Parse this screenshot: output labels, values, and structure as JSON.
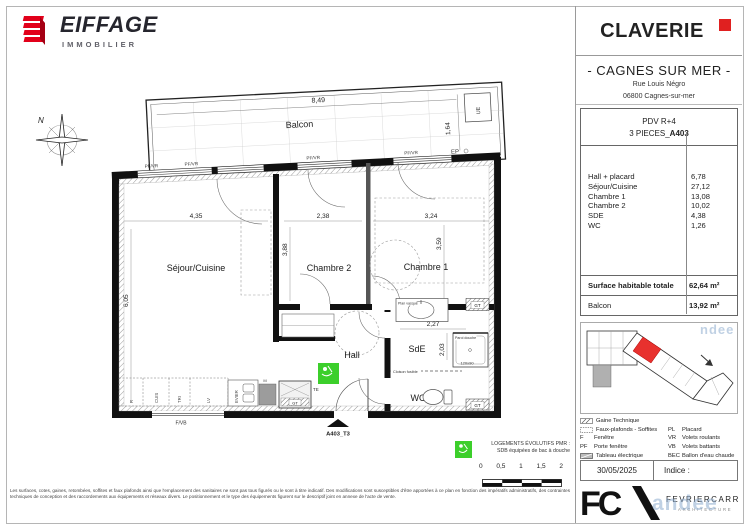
{
  "colors": {
    "accent_red": "#e2001a",
    "pmr_green": "#3ccf2b",
    "keyplan_red": "#e8312e",
    "watermark_blue": "#9db8d2"
  },
  "header": {
    "brand": "EIFFAGE",
    "brand_sub": "IMMOBILIER",
    "project": "CLAVERIE",
    "city": "- CAGNES SUR MER -",
    "address1": "Rue Louis Négro",
    "address2": "06800 Cagnes-sur-mer"
  },
  "unit": {
    "level": "PDV R+4",
    "type_prefix": "3 PIECES_",
    "type_code": "A403",
    "rooms": [
      {
        "name": "Hall + placard",
        "area": "6,78"
      },
      {
        "name": "Séjour/Cuisine",
        "area": "27,12"
      },
      {
        "name": "Chambre 1",
        "area": "13,08"
      },
      {
        "name": "Chambre 2",
        "area": "10,02"
      },
      {
        "name": "SDE",
        "area": "4,38"
      },
      {
        "name": "WC",
        "area": "1,26"
      }
    ],
    "total_label": "Surface habitable totale",
    "total_value": "62,64 m²",
    "balcony_label": "Balcon",
    "balcony_value": "13,92 m²"
  },
  "plan": {
    "compass_n": "N",
    "rooms": {
      "balcon": "Balcon",
      "sejour": "Séjour/Cuisine",
      "chambre2": "Chambre 2",
      "chambre1": "Chambre 1",
      "hall": "Hall",
      "sde": "SdE",
      "wc": "WC"
    },
    "dims": {
      "balcon_w": "8,49",
      "balcon_d": "1,64",
      "sejour_w": "4,35",
      "sejour_h": "6,05",
      "ch2_w": "2,38",
      "ch2_h": "3,88",
      "ch1_w": "3,24",
      "ch1_h": "3,59",
      "sde_w": "2,27",
      "sde_h": "2,03"
    },
    "labels": {
      "pf_vr": "PF/VR",
      "f_vb": "F/VB",
      "ue": "UE",
      "ep": "EP",
      "gt": "GT",
      "te": "TE",
      "r": "R",
      "cuis": "CUIS",
      "tri": "TRI",
      "lv": "LV",
      "evier": "EVIER",
      "m": "M",
      "vasque": "Plan vasque",
      "paroi": "Paroi douche",
      "shower_size": "120x90",
      "cloison": "Cloison fusible",
      "entrance": "A403_T3"
    }
  },
  "legend": {
    "col1": [
      {
        "abbr": "",
        "label": "Gaine Technique"
      },
      {
        "abbr": "",
        "label": "Faux-plafonds - Soffites"
      },
      {
        "abbr": "F",
        "label": "Fenêtre"
      },
      {
        "abbr": "PF",
        "label": "Porte fenêtre"
      },
      {
        "abbr": "",
        "label": "Tableau électrique"
      }
    ],
    "col2": [
      {
        "abbr": "PL",
        "label": "Placard"
      },
      {
        "abbr": "VR",
        "label": "Volets roulants"
      },
      {
        "abbr": "VB",
        "label": "Volets battants"
      },
      {
        "abbr": "BEC",
        "label": "Ballon d'eau chaude"
      }
    ]
  },
  "pmr": {
    "line1": "LOGEMENTS ÉVOLUTIFS PMR :",
    "line2": "SDB équipées de bac à douche"
  },
  "scale": {
    "t0": "0",
    "t1": "0,5",
    "t2": "1",
    "t3": "1,5",
    "t4": "2"
  },
  "footer": {
    "date": "30/05/2025",
    "indice": "Indice :",
    "architect": "FEVRIERCARRE",
    "architect_sub": "ARCHITECTURE"
  },
  "watermark": {
    "top": "ndee",
    "bottom": "andee"
  },
  "disclaimer": "Les surfaces, cotes, gaines, retombées, soffites et faux plafonds ainsi que l'emplacement des sanitaires ne sont pas tous figurés ou le sont à titre indicatif. Des modifications sont susceptibles d'être apportées à ce plan en fonction des impératifs administratifs, des contraintes techniques de conception et des raccordements aux équipements et réseaux divers. Le positionnement et le type des équipements figurent sur le descriptif joint en annexe de l'acte de vente."
}
